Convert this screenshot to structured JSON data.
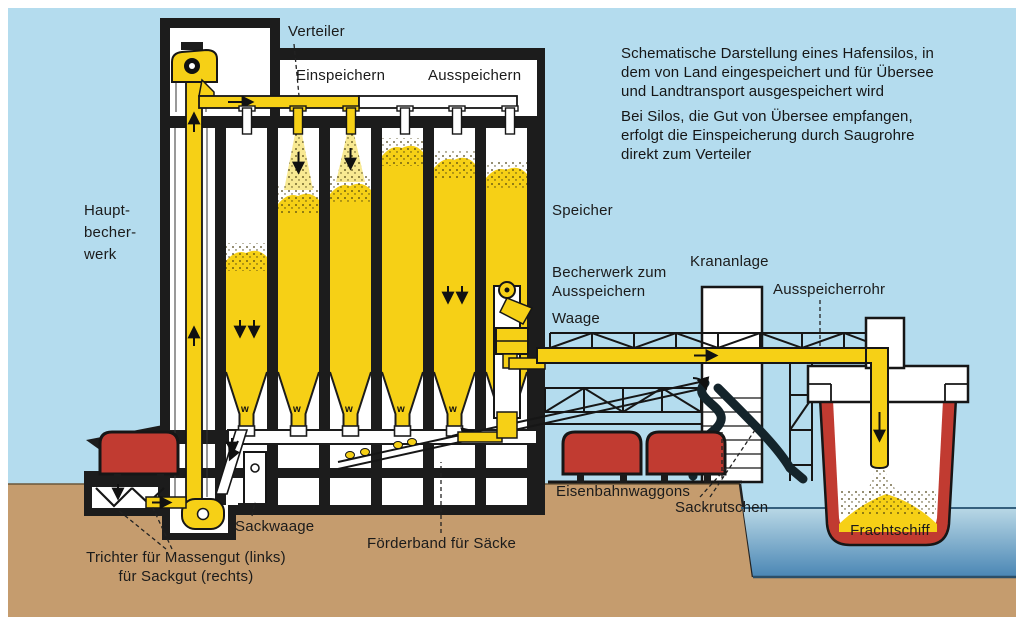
{
  "diagram": {
    "title_hint": "Schematic of a harbor silo",
    "info_text": {
      "p1": [
        "Schematische Darstellung eines Hafensilos, in",
        "dem von Land eingespeichert und für Übersee",
        "und Landtransport ausgespeichert wird"
      ],
      "p2": [
        "Bei Silos, die Gut von Übersee empfangen,",
        "erfolgt die Einspeicherung durch Saugrohre",
        "direkt zum Verteiler"
      ]
    },
    "labels": {
      "verteiler": "Verteiler",
      "einspeichern": "Einspeichern",
      "ausspeichern": "Ausspeichern",
      "hauptbecherwerk": [
        "Haupt-",
        "becher-",
        "werk"
      ],
      "speicher": "Speicher",
      "becherwerk_ausspeichern": [
        "Becherwerk zum",
        "Ausspeichern"
      ],
      "waage": "Waage",
      "krananlage": "Krananlage",
      "ausspeicherrohr": "Ausspeicherrohr",
      "sackwaage": "Sackwaage",
      "foerderband": "Förderband für Säcke",
      "eisenbahnwaggons": "Eisenbahnwaggons",
      "sackrutschen": "Sackrutschen",
      "frachtschiff": "Frachtschiff",
      "trichter": [
        "Trichter für Massengut (links)",
        "für Sackgut (rechts)"
      ]
    },
    "hopper_mark": "w",
    "colors": {
      "sky": "#b4dcee",
      "ground": "#c59c6e",
      "grain": "#f6d016",
      "grain_light": "#f8e992",
      "red": "#c13b31",
      "water_top": "#b9d8e6",
      "water_bottom": "#4a86b4",
      "ink": "#161616",
      "white": "#ffffff"
    }
  }
}
